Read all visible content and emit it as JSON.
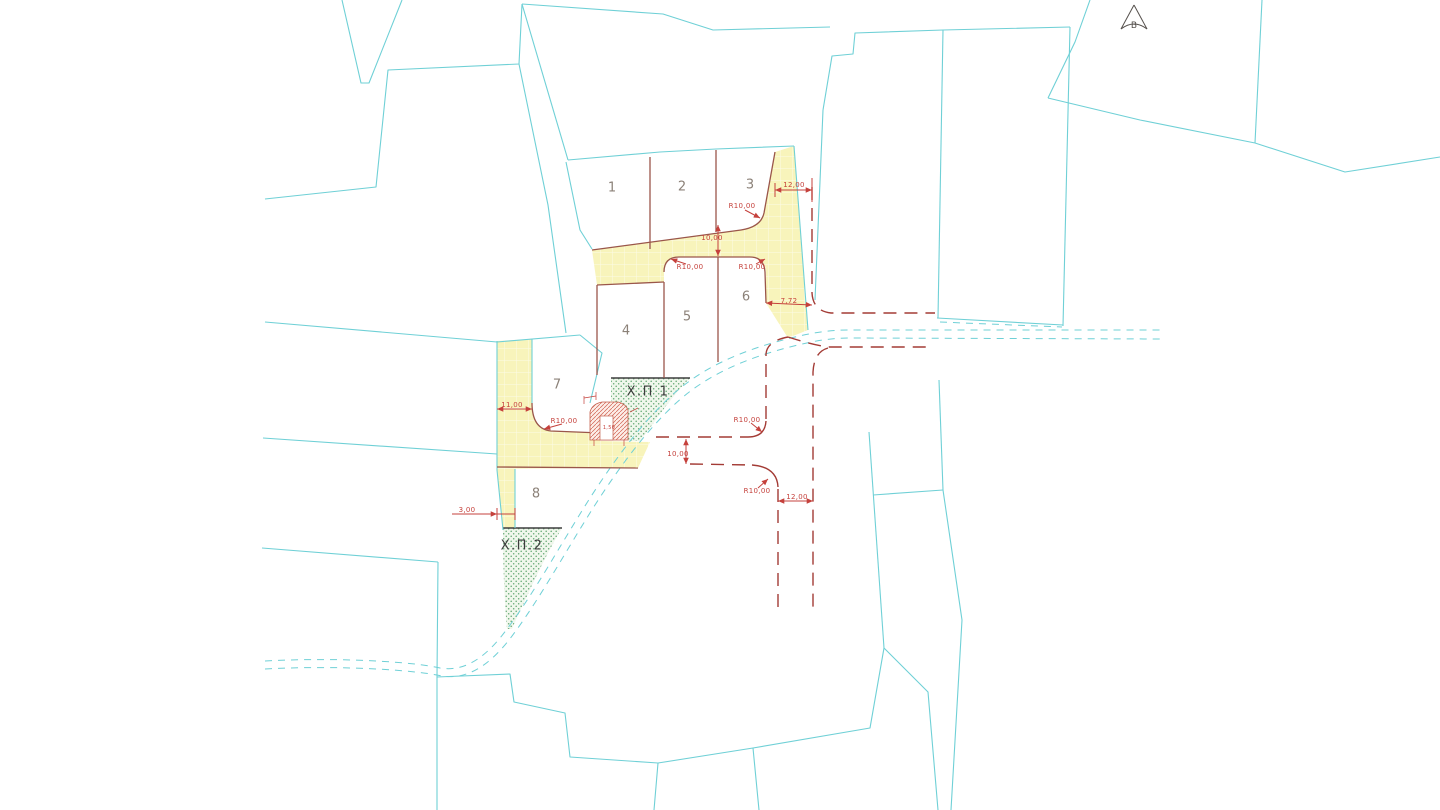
{
  "drawing": {
    "north_arrow": {
      "label": "В"
    },
    "zones": [
      {
        "id": "zone-label-xp1",
        "label": "Х.П 1",
        "x": 648,
        "y": 392
      },
      {
        "id": "zone-label-xp2",
        "label": "Х.П.2",
        "x": 522,
        "y": 546
      }
    ],
    "plots": [
      {
        "id": "plot-number-1",
        "label": "1",
        "x": 612,
        "y": 188
      },
      {
        "id": "plot-number-2",
        "label": "2",
        "x": 682,
        "y": 187
      },
      {
        "id": "plot-number-3",
        "label": "3",
        "x": 750,
        "y": 185
      },
      {
        "id": "plot-number-4",
        "label": "4",
        "x": 626,
        "y": 331
      },
      {
        "id": "plot-number-5",
        "label": "5",
        "x": 687,
        "y": 317
      },
      {
        "id": "plot-number-6",
        "label": "6",
        "x": 746,
        "y": 297
      },
      {
        "id": "plot-number-7",
        "label": "7",
        "x": 557,
        "y": 385
      },
      {
        "id": "plot-number-8",
        "label": "8",
        "x": 536,
        "y": 494
      }
    ],
    "dimensions": [
      {
        "id": "dim-road-width-ne",
        "label": "12,00",
        "x": 794,
        "y": 185
      },
      {
        "id": "dim-radius-plot3",
        "label": "R10,00",
        "x": 742,
        "y": 206
      },
      {
        "id": "dim-road-width-top",
        "label": "10,00",
        "x": 712,
        "y": 238
      },
      {
        "id": "dim-radius-block-left",
        "label": "R10,00",
        "x": 690,
        "y": 267
      },
      {
        "id": "dim-radius-block-right",
        "label": "R10,00",
        "x": 752,
        "y": 267
      },
      {
        "id": "dim-width-7-72",
        "label": "7,72",
        "x": 789,
        "y": 301
      },
      {
        "id": "dim-width-11-00",
        "label": "11,00",
        "x": 512,
        "y": 405
      },
      {
        "id": "dim-radius-plot7",
        "label": "R10,00",
        "x": 564,
        "y": 421
      },
      {
        "id": "dim-structure-1-50",
        "label": "1,50",
        "x": 609,
        "y": 428,
        "small": true
      },
      {
        "id": "dim-radius-mid",
        "label": "R10,00",
        "x": 747,
        "y": 420
      },
      {
        "id": "dim-road-width-mid",
        "label": "10,00",
        "x": 678,
        "y": 454
      },
      {
        "id": "dim-radius-south",
        "label": "R10,00",
        "x": 757,
        "y": 491
      },
      {
        "id": "dim-road-width-south",
        "label": "12,00",
        "x": 797,
        "y": 497
      },
      {
        "id": "dim-width-3-00",
        "label": "3,00",
        "x": 467,
        "y": 510
      }
    ],
    "colors": {
      "parcel_line": "#6fd0d6",
      "regulation_line": "#9a564a",
      "dimension_red": "#c5413c",
      "road_fill_yellow": "#f8f4bb",
      "green_zone_dot": "#63a873"
    }
  }
}
